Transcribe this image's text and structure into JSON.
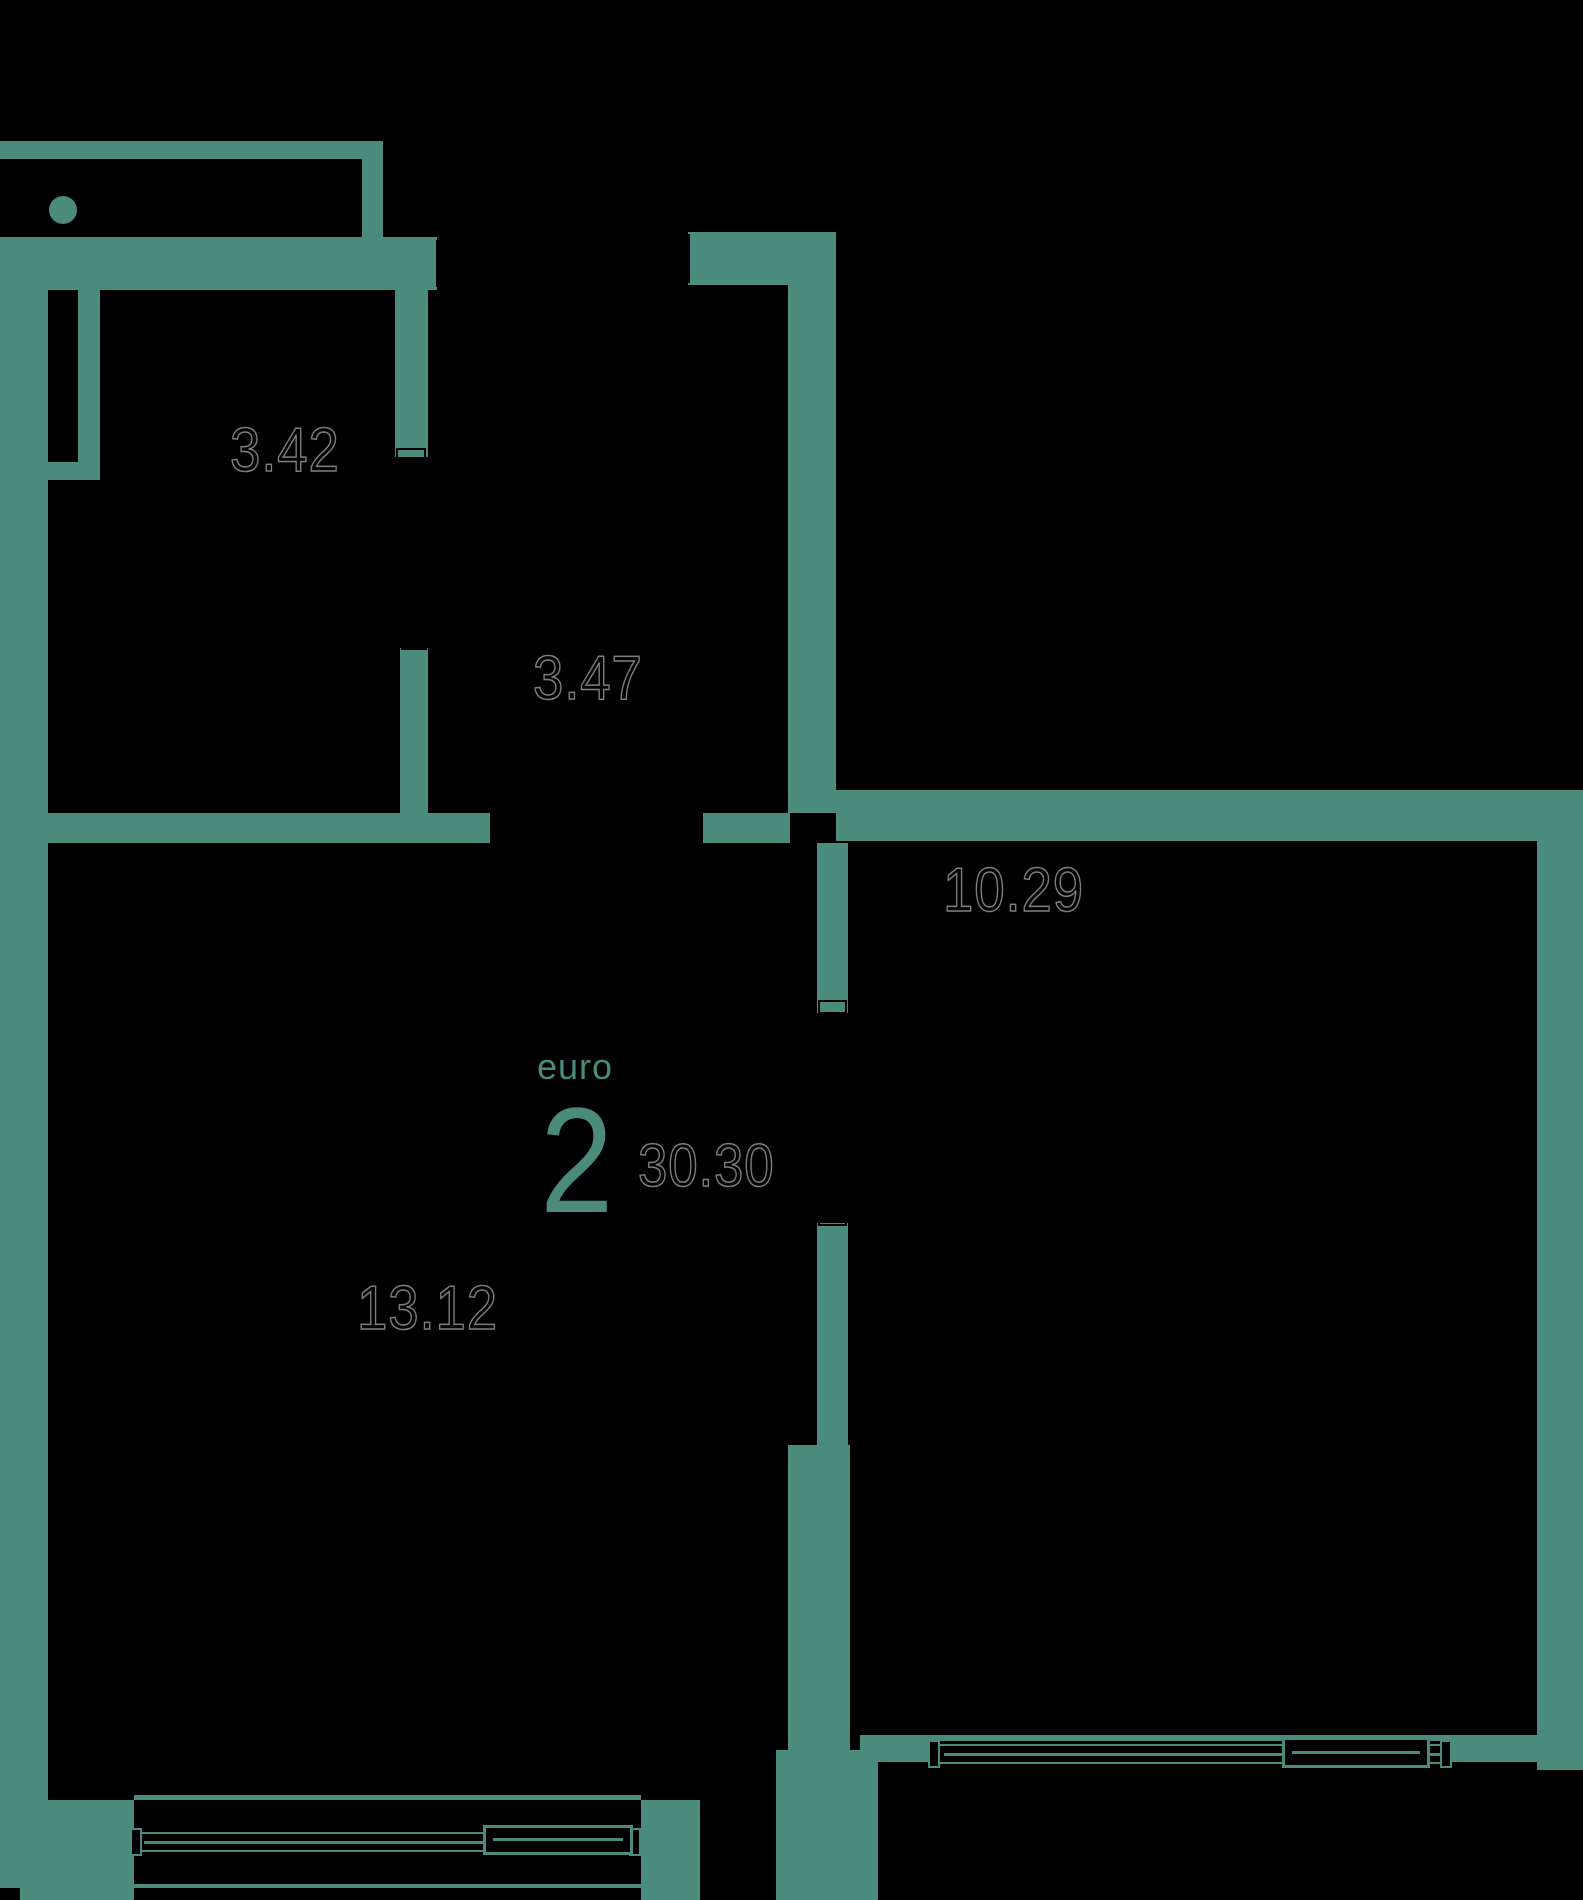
{
  "plan": {
    "type_label": "euro",
    "type_number": "2",
    "total_area": "30.30",
    "rooms": [
      {
        "name": "bathroom",
        "area": "3.42"
      },
      {
        "name": "hallway",
        "area": "3.47"
      },
      {
        "name": "bedroom",
        "area": "10.29"
      },
      {
        "name": "living-kitchen",
        "area": "13.12"
      }
    ]
  },
  "colors": {
    "wall": "#4A8B7C",
    "background": "#000000",
    "area_label_fill": "#000000",
    "area_label_outline": "#7D7D7D"
  }
}
